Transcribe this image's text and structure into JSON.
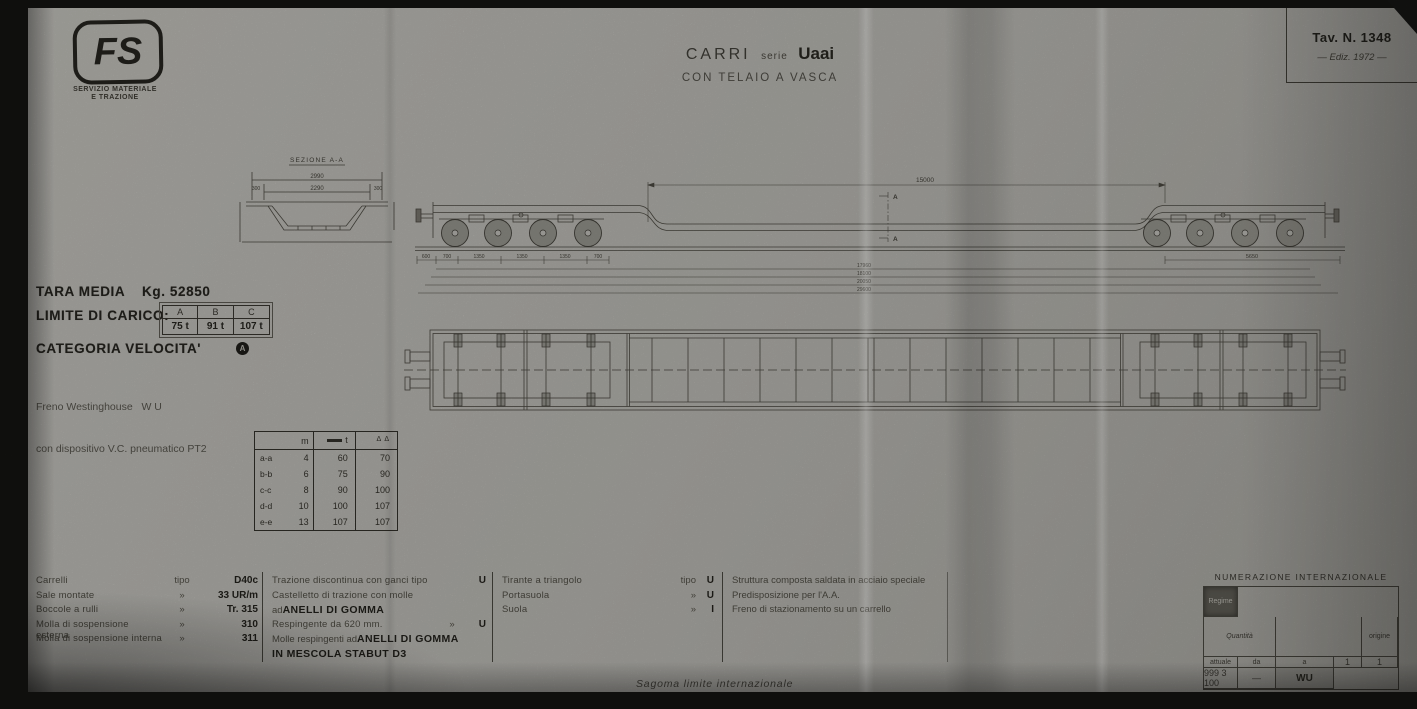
{
  "logo": {
    "fs": "FS",
    "sub1": "SERVIZIO MATERIALE",
    "sub2": "E TRAZIONE"
  },
  "title": {
    "main": "CARRI",
    "serie": "serie",
    "name": "Uaai",
    "sub": "CON TELAIO A VASCA"
  },
  "plate": {
    "tav": "Tav. N. 1348",
    "ediz": "— Ediz. 1972 —"
  },
  "specs": {
    "tara_label": "TARA MEDIA",
    "tara_value": "Kg. 52850",
    "limite_label": "LIMITE DI CARICO:",
    "limite": {
      "h1": "A",
      "h2": "B",
      "h3": "C",
      "v1": "75 t",
      "v2": "91 t",
      "v3": "107 t"
    },
    "categoria_label": "CATEGORIA VELOCITA'",
    "categoria_badge": "A",
    "freno1": "Freno Westinghouse   W U",
    "freno2": "con dispositivo V.C. pneumatico PT2"
  },
  "load_table": {
    "h_m": "m",
    "h_dist_t": "t",
    "h_conc": "Δ Δ",
    "rows": [
      {
        "id": "a-a",
        "m": "4",
        "dist": "60",
        "conc": "70"
      },
      {
        "id": "b-b",
        "m": "6",
        "dist": "75",
        "conc": "90"
      },
      {
        "id": "c-c",
        "m": "8",
        "dist": "90",
        "conc": "100"
      },
      {
        "id": "d-d",
        "m": "10",
        "dist": "100",
        "conc": "107"
      },
      {
        "id": "e-e",
        "m": "13",
        "dist": "107",
        "conc": "107"
      }
    ]
  },
  "dims": {
    "section_title": "SEZIONE A-A",
    "sec_w_out": "2990",
    "sec_w_in": "2290",
    "sec_side_l": "300",
    "sec_side_r": "300",
    "side_span": "15000",
    "ax1": "600",
    "ax2": "700",
    "ax3": "1350",
    "ax4": "1350",
    "ax5": "1350",
    "ax6": "700",
    "bogie": "5650",
    "len1": "17960",
    "len2": "18100",
    "len3": "20050",
    "len4": "29600",
    "section_mark": "A"
  },
  "parts": {
    "rows": [
      {
        "name": "Carrelli",
        "sep": "tipo",
        "val": "D40c"
      },
      {
        "name": "Sale montate",
        "sep": "»",
        "val": "33 UR/m"
      },
      {
        "name": "Boccole a rulli",
        "sep": "»",
        "val": "Tr. 315"
      },
      {
        "name": "Molla di sospensione esterna",
        "sep": "»",
        "val": "310"
      },
      {
        "name": "Molla di sospensione interna",
        "sep": "»",
        "val": "311"
      }
    ]
  },
  "traction": {
    "l1a": "Trazione discontinua con ganci  tipo",
    "l1v": "U",
    "l2": "Castelletto di trazione con molle",
    "l3a": "ad ",
    "l3b": "ANELLI DI GOMMA",
    "l4a": "Respingente da 620 mm.",
    "l4s": "»",
    "l4v": "U",
    "l5a": "Molle respingenti ad ",
    "l5b": "ANELLI DI GOMMA",
    "l6": "IN MESCOLA STABUT D3"
  },
  "brake": {
    "rows": [
      {
        "name": "Tirante a triangolo",
        "sep": "tipo",
        "val": "U"
      },
      {
        "name": "Portasuola",
        "sep": "»",
        "val": "U"
      },
      {
        "name": "Suola",
        "sep": "»",
        "val": "I"
      }
    ]
  },
  "structure": {
    "l1": "Struttura composta saldata in acciaio speciale",
    "l2": "Predisposizione per l'A.A.",
    "l3": "Freno di stazionamento su un carrello"
  },
  "numbering": {
    "title": "NUMERAZIONE INTERNAZIONALE",
    "quantita": "Quantità",
    "origine": "origine",
    "attuale": "attuale",
    "da": "da",
    "a": "a",
    "regime": "Regime",
    "r_origine": "1",
    "r_attuale": "1",
    "r_da": "999 3 100",
    "r_a": "—",
    "r_regime": "WU"
  },
  "footer": {
    "note": "Sagoma limite internazionale"
  }
}
